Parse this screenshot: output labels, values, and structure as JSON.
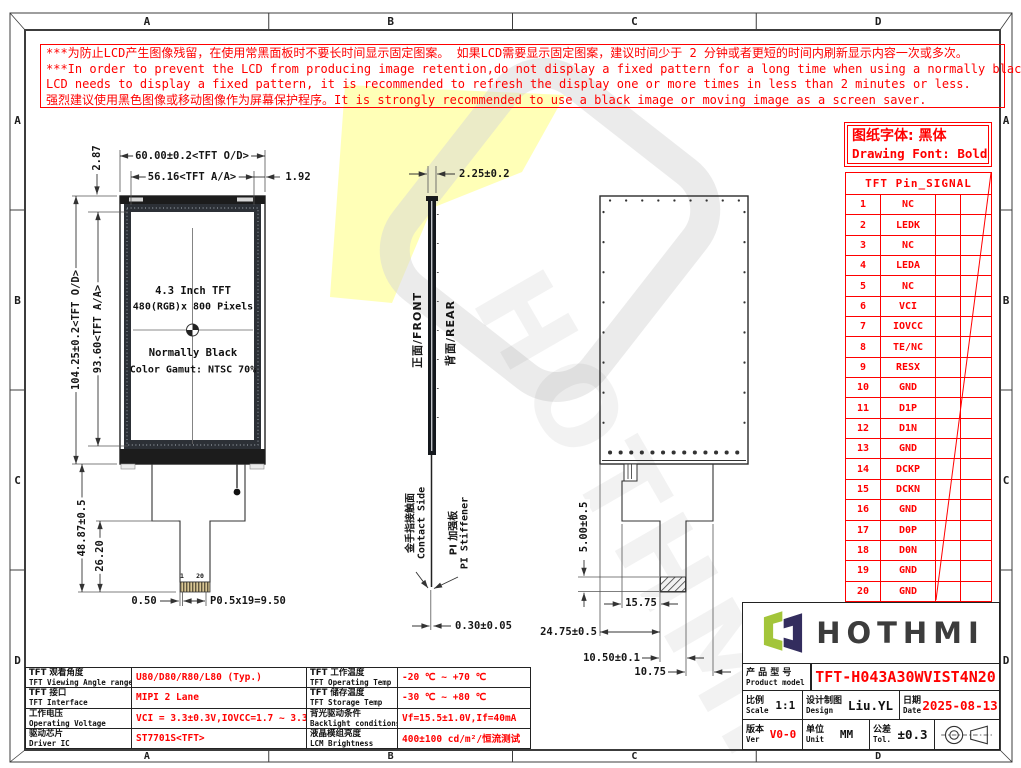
{
  "frame": {
    "zones": {
      "top": [
        "A",
        "B",
        "C",
        "D"
      ],
      "bottom": [
        "A",
        "B",
        "C",
        "D"
      ],
      "left": [
        "A",
        "B",
        "C",
        "D"
      ],
      "right": [
        "A",
        "B",
        "C",
        "D"
      ]
    }
  },
  "warning": {
    "lines": [
      "***为防止LCD产生图像残留，在使用常黑面板时不要长时间显示固定图案。 如果LCD需要显示固定图案，建议时间少于 2 分钟或者更短的时间内刷新显示内容一次或多次。",
      "***In order to prevent the LCD from producing image retention,do not display a fixed pattern for a long time when using a normally black panel.If the",
      " LCD needs to display a fixed pattern, it is recommended to refresh the display one or more times in less than 2 minutes or less.",
      "强烈建议使用黑色图像或移动图像作为屏幕保护程序。It is strongly recommended to use a black image or moving image as a screen saver."
    ]
  },
  "font_note": {
    "cn": "图纸字体: 黑体",
    "en": "Drawing Font: Bold"
  },
  "front_view": {
    "line1": "4.3 Inch TFT",
    "line2": "480(RGB)x 800 Pixels",
    "line3": "Normally Black",
    "line4": "Color Gamut: NTSC 70%",
    "dims": {
      "outline_width": "60.00±0.2<TFT O/D>",
      "active_width": "56.16<TFT A/A>",
      "right_margin": "1.92",
      "top_margin": "2.87",
      "outline_height": "104.25±0.2<TFT O/D>",
      "active_height": "93.60<TFT A/A>",
      "fpc_length": "48.87±0.5",
      "tail_length": "26.20",
      "pin_margin": "0.50",
      "pin_pitch": "P0.5x19=9.50",
      "pin_first": "1",
      "pin_last": "20"
    }
  },
  "side_view": {
    "front_label": "正面/FRONT",
    "rear_label": "背面/REAR",
    "thickness": "2.25±0.2",
    "contact_cn": "金手指接触面",
    "contact_en": "Contact Side",
    "stiffener_cn": "PI 加强板",
    "stiffener_en": "PI Stiffener",
    "fpc_thickness": "0.30±0.05"
  },
  "rear_view": {
    "dims": {
      "stiffener_height": "5.00±0.5",
      "comp_offset": "15.75",
      "fpc_width": "24.75±0.5",
      "tail_width": "10.50±0.1",
      "tail_right_offset": "10.75"
    }
  },
  "pin_table": {
    "title": "TFT Pin_SIGNAL",
    "rows": [
      {
        "pin": "1",
        "signal": "NC"
      },
      {
        "pin": "2",
        "signal": "LEDK"
      },
      {
        "pin": "3",
        "signal": "NC"
      },
      {
        "pin": "4",
        "signal": "LEDA"
      },
      {
        "pin": "5",
        "signal": "NC"
      },
      {
        "pin": "6",
        "signal": "VCI"
      },
      {
        "pin": "7",
        "signal": "IOVCC"
      },
      {
        "pin": "8",
        "signal": "TE/NC"
      },
      {
        "pin": "9",
        "signal": "RESX"
      },
      {
        "pin": "10",
        "signal": "GND"
      },
      {
        "pin": "11",
        "signal": "D1P"
      },
      {
        "pin": "12",
        "signal": "D1N"
      },
      {
        "pin": "13",
        "signal": "GND"
      },
      {
        "pin": "14",
        "signal": "DCKP"
      },
      {
        "pin": "15",
        "signal": "DCKN"
      },
      {
        "pin": "16",
        "signal": "GND"
      },
      {
        "pin": "17",
        "signal": "D0P"
      },
      {
        "pin": "18",
        "signal": "D0N"
      },
      {
        "pin": "19",
        "signal": "GND"
      },
      {
        "pin": "20",
        "signal": "GND"
      }
    ]
  },
  "spec_table": {
    "rows": [
      {
        "label1_cn": "TFT 观看角度",
        "label1_en": "TFT Viewing Angle range",
        "value1": "U80/D80/R80/L80 (Typ.)",
        "label2_cn": "TFT 工作温度",
        "label2_en": "TFT Operating Temp",
        "value2": "-20 ℃ ~ +70 ℃"
      },
      {
        "label1_cn": "TFT 接口",
        "label1_en": "TFT Interface",
        "value1": "MIPI 2 Lane",
        "label2_cn": "TFT 储存温度",
        "label2_en": "TFT Storage Temp",
        "value2": "-30 ℃ ~ +80 ℃"
      },
      {
        "label1_cn": "工作电压",
        "label1_en": "Operating Voltage",
        "value1": "VCI = 3.3±0.3V,IOVCC=1.7 ~ 3.3V",
        "label2_cn": "背光驱动条件",
        "label2_en": "Backlight conditions",
        "value2": "Vf=15.5±1.0V,If=40mA"
      },
      {
        "label1_cn": "驱动芯片",
        "label1_en": "Driver IC",
        "value1": "ST7701S<TFT>",
        "label2_cn": "液晶模组亮度",
        "label2_en": "LCM Brightness",
        "value2": "400±100 cd/m²/恒流测试"
      }
    ]
  },
  "title_block": {
    "brand": "HOTHMI",
    "product_label_cn": "产 品 型 号",
    "product_label_en": "Product model",
    "model": "TFT-H043A30WVIST4N20",
    "scale_label_cn": "比例",
    "scale_label_en": "Scale",
    "scale": "1:1",
    "design_label_cn": "设计制图",
    "design_label_en": "Design",
    "designer": "Liu.YL",
    "date_label_cn": "日期",
    "date_label_en": "Date",
    "date": "2025-08-13",
    "ver_label_cn": "版本",
    "ver_label_en": "Ver",
    "version": "V0-0",
    "unit_label_cn": "单位",
    "unit_label_en": "Unit",
    "unit": "MM",
    "tol_label_cn": "公差",
    "tol_label_en": "Tol.",
    "tolerance": "±0.3"
  },
  "watermark": {
    "text": "HOTHMI"
  },
  "colors": {
    "red": "#ff0000",
    "logo_green": "#a3c53a",
    "logo_navy": "#332d5e",
    "line": "#333333"
  }
}
